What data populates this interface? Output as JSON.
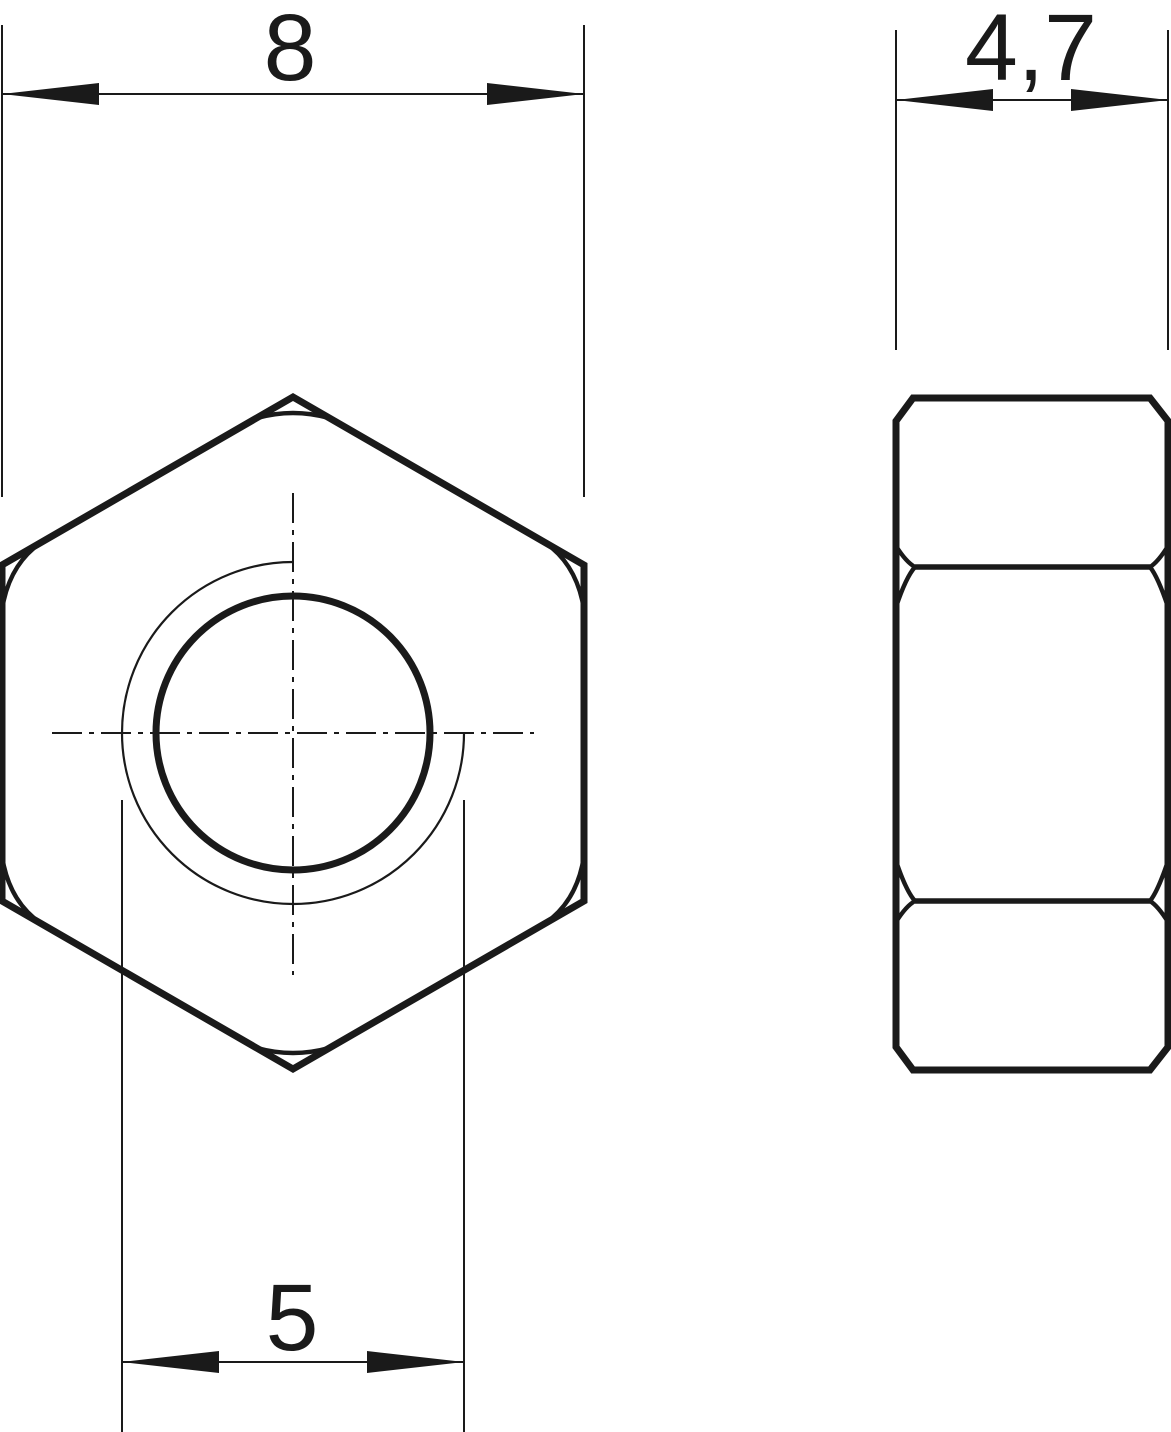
{
  "drawing": {
    "ink_color": "#1a1a1a",
    "background_color": "#ffffff",
    "labels": {
      "across_flats": "8",
      "thickness": "4,7",
      "thread_diameter": "5"
    }
  }
}
